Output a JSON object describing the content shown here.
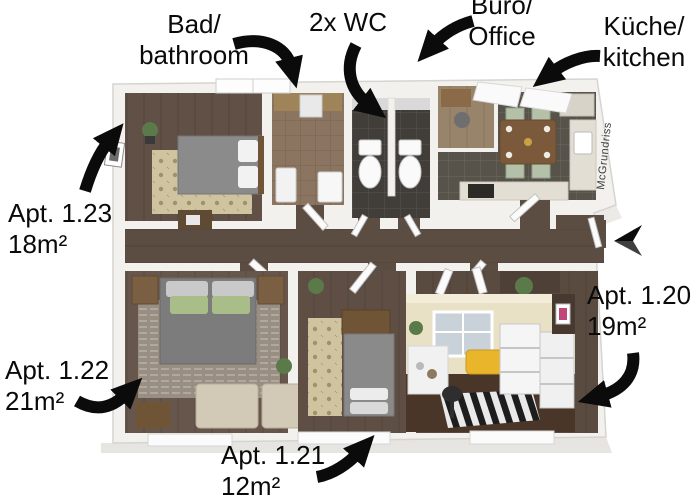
{
  "figure": {
    "type": "annotated-3d-floor-plan",
    "description_visible_only": "3D rendered shared-apartment floor plan with black curved arrows labeling rooms, plus an inset photo of one room"
  },
  "labels": {
    "bathroom": {
      "line1": "Bad/",
      "line2": "bathroom"
    },
    "wc": {
      "line1": "2x WC"
    },
    "office": {
      "line1": "Büro/",
      "line2": "Office"
    },
    "kitchen": {
      "line1": "Küche/",
      "line2": "kitchen"
    },
    "apt_1_23": {
      "line1": "Apt. 1.23",
      "line2": "18m²"
    },
    "apt_1_22": {
      "line1": "Apt. 1.22",
      "line2": "21m²"
    },
    "apt_1_21": {
      "line1": "Apt. 1.21",
      "line2": "12m²"
    },
    "apt_1_20": {
      "line1": "Apt. 1.20",
      "line2": "19m²"
    }
  },
  "watermark": {
    "text": "McGrundriss"
  },
  "icons": {
    "arrows": [
      "curved-arrow-bathroom-icon",
      "curved-arrow-wc-icon",
      "curved-arrow-office-icon",
      "curved-arrow-kitchen-icon",
      "curved-arrow-apt-1-23-icon",
      "curved-arrow-apt-1-22-icon",
      "curved-arrow-apt-1-21-icon",
      "curved-arrow-apt-1-20-icon",
      "entrance-arrow-icon"
    ]
  },
  "colors": {
    "label_text": "#0a0a0a",
    "arrow_black": "#0b0b0b",
    "wall_white": "#f2f1ee",
    "wood_floor": "#5f5046",
    "bathroom_tile": "#8b7560",
    "wc_floor": "#413d38",
    "kitchen_floor": "#58534a",
    "rug_beige": "#cfc49f",
    "rug_gray": "#988f82",
    "bed_gray": "#8a8a8a",
    "pillow_green": "#a8bd88",
    "sofa_beige": "#d2c9b6",
    "furniture_brown": "#6f5436",
    "chair_sage": "#b4c0a8",
    "photo_wall_cream": "#e9e1c6",
    "photo_accent_yellow": "#e9b62b",
    "photo_floor_brown": "#4a3628",
    "photo_dark_wall": "#473930"
  }
}
